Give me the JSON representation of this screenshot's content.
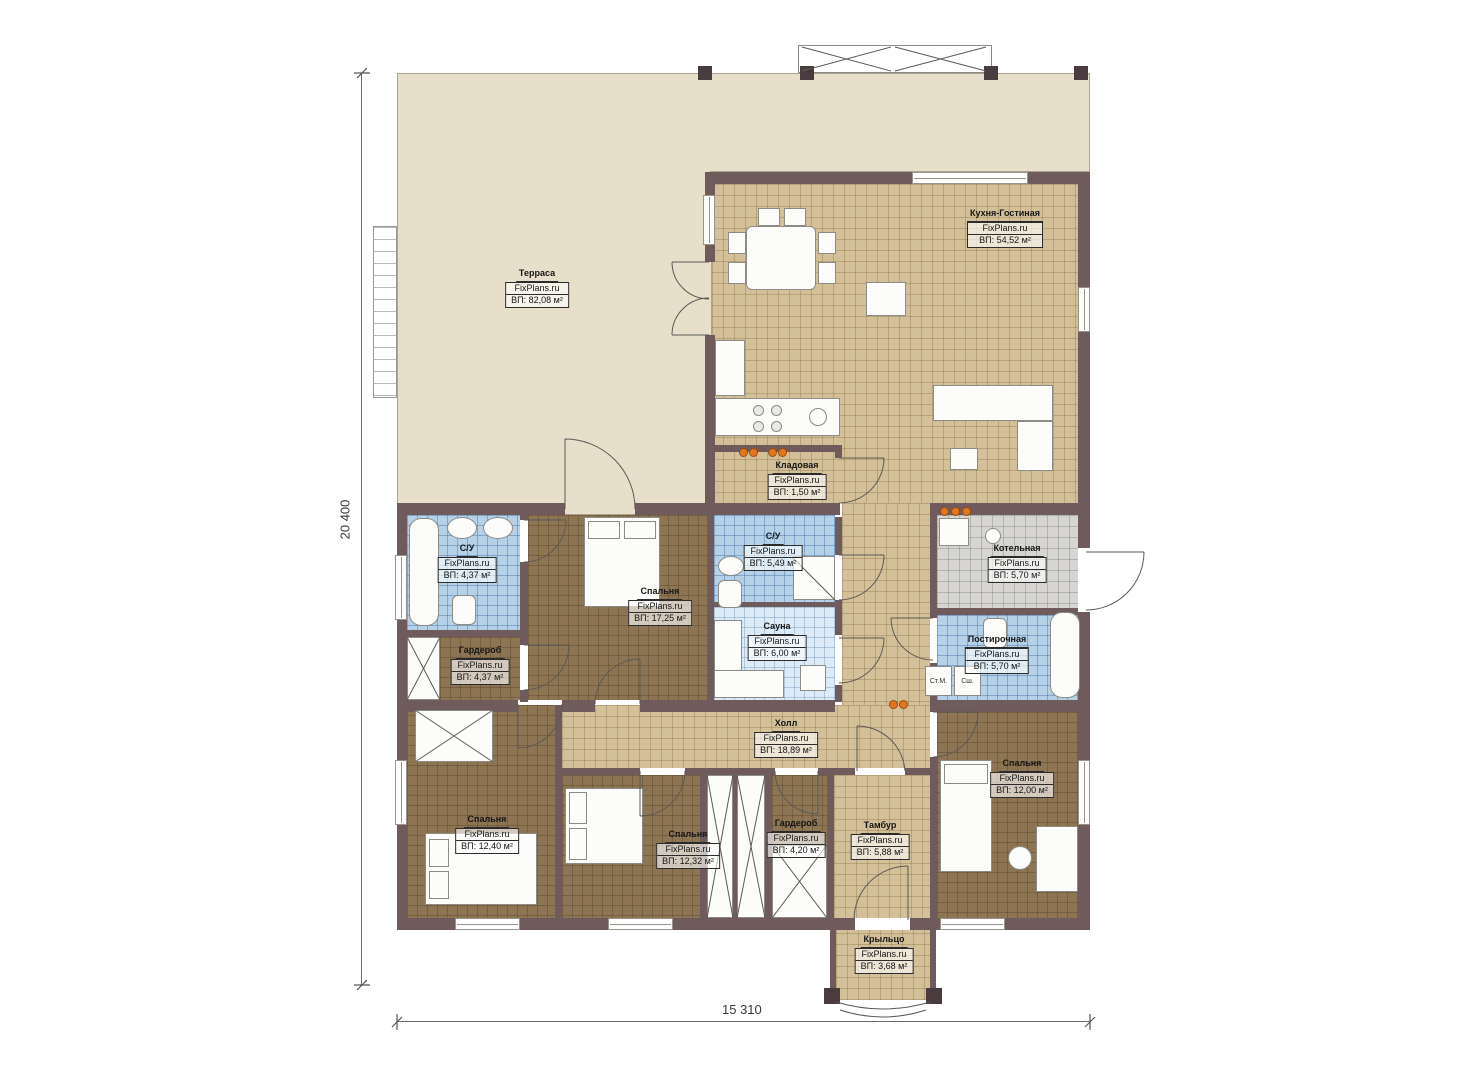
{
  "dimensions": {
    "left": "20 400",
    "bottom": "15 310"
  },
  "appliances": {
    "washer": "Ст.М.",
    "dryer": "Сш."
  },
  "rooms": [
    {
      "name": "Терраса",
      "brand": "FixPlans.ru",
      "area": "ВП: 82,08 м²"
    },
    {
      "name": "Кухня-Гостиная",
      "brand": "FixPlans.ru",
      "area": "ВП: 54,52 м²"
    },
    {
      "name": "Кладовая",
      "brand": "FixPlans.ru",
      "area": "ВП: 1,50 м²"
    },
    {
      "name": "С/У",
      "brand": "FixPlans.ru",
      "area": "ВП: 4,37 м²"
    },
    {
      "name": "С/У",
      "brand": "FixPlans.ru",
      "area": "ВП: 5,49 м²"
    },
    {
      "name": "Котельная",
      "brand": "FixPlans.ru",
      "area": "ВП: 5,70 м²"
    },
    {
      "name": "Спальня",
      "brand": "FixPlans.ru",
      "area": "ВП: 17,25 м²"
    },
    {
      "name": "Сауна",
      "brand": "FixPlans.ru",
      "area": "ВП: 6,00 м²"
    },
    {
      "name": "Гардероб",
      "brand": "FixPlans.ru",
      "area": "ВП: 4,37 м²"
    },
    {
      "name": "Постирочная",
      "brand": "FixPlans.ru",
      "area": "ВП: 5,70 м²"
    },
    {
      "name": "Холл",
      "brand": "FixPlans.ru",
      "area": "ВП: 18,89 м²"
    },
    {
      "name": "Спальня",
      "brand": "FixPlans.ru",
      "area": "ВП: 12,40 м²"
    },
    {
      "name": "Спальня",
      "brand": "FixPlans.ru",
      "area": "ВП: 12,32 м²"
    },
    {
      "name": "Гардероб",
      "brand": "FixPlans.ru",
      "area": "ВП: 4,20 м²"
    },
    {
      "name": "Тамбур",
      "brand": "FixPlans.ru",
      "area": "ВП: 5,88 м²"
    },
    {
      "name": "Спальня",
      "brand": "FixPlans.ru",
      "area": "ВП: 12,00 м²"
    },
    {
      "name": "Крыльцо",
      "brand": "FixPlans.ru",
      "area": "ВП: 3,68 м²"
    }
  ]
}
